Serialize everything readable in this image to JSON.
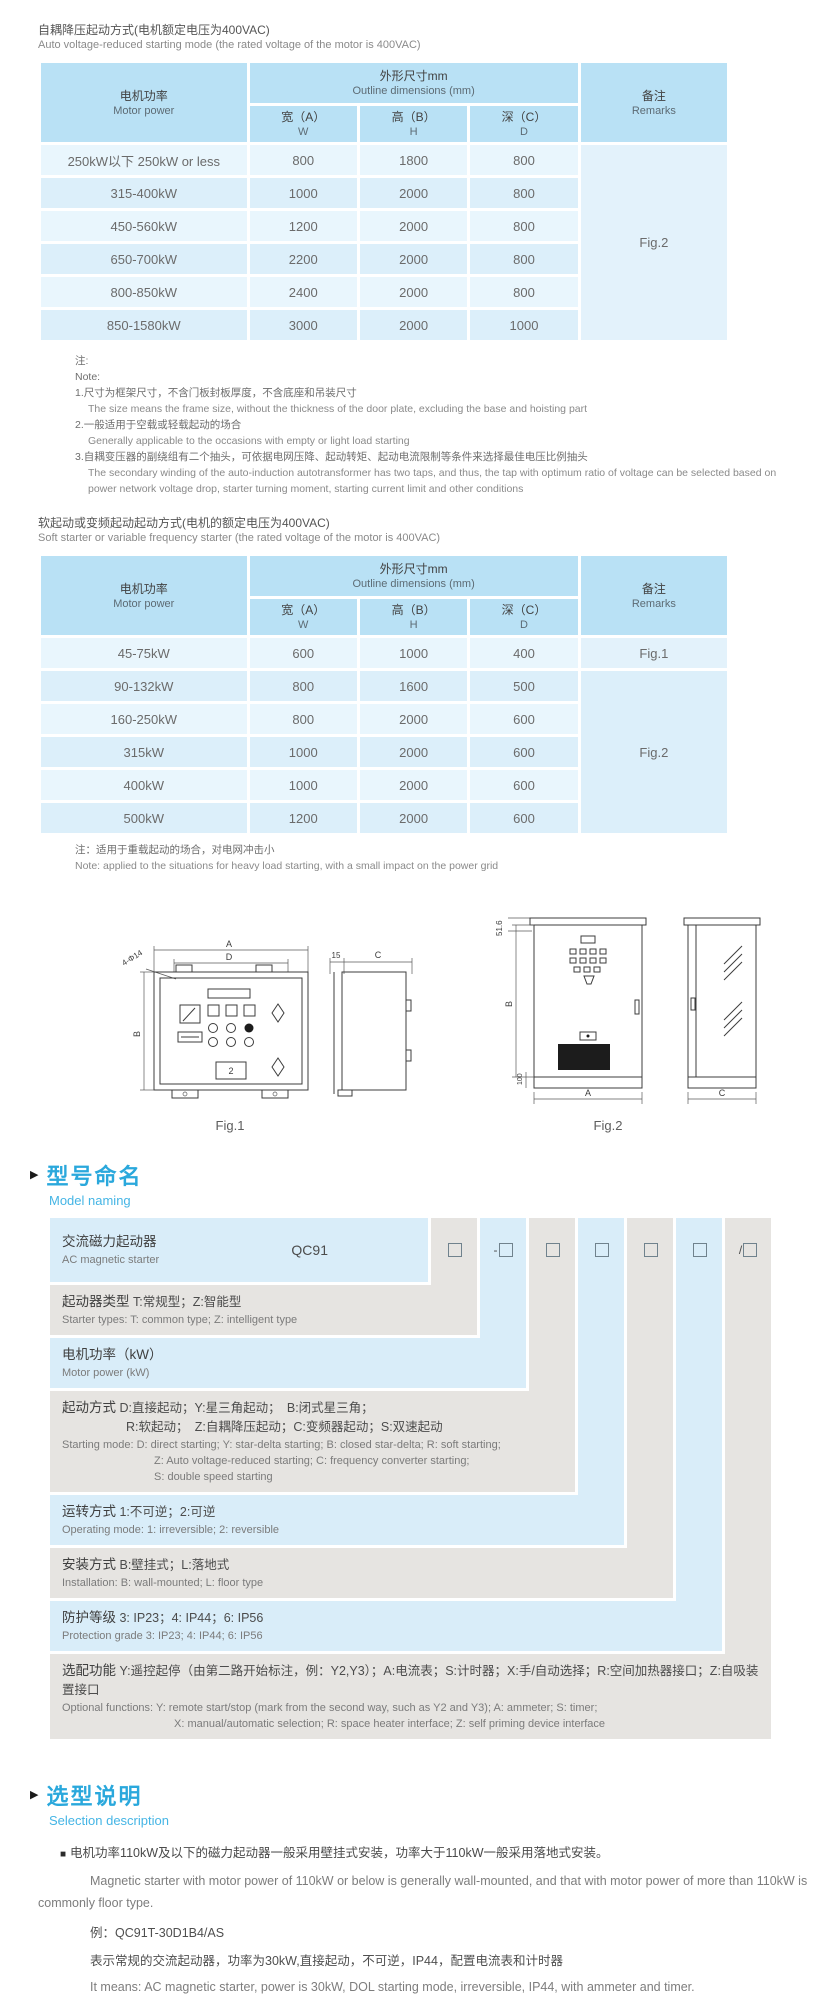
{
  "colors": {
    "heading_blue": "#2aa8dc",
    "heading_blue_light": "#45b5e5",
    "table_header_bg": "#b9e1f5",
    "row_blue_light": "#e9f6fd",
    "row_blue": "#dceffa",
    "model_gray": "#e6e4e1",
    "model_blue": "#d9edf9"
  },
  "ui": {
    "section_marker": "▶",
    "bullet": "■"
  },
  "table_header": {
    "motor_cn": "电机功率",
    "motor_en": "Motor power",
    "dims_cn": "外形尺寸mm",
    "dims_en": "Outline dimensions (mm)",
    "w_cn": "宽（A）",
    "w_en": "W",
    "h_cn": "高（B）",
    "h_en": "H",
    "d_cn": "深（C）",
    "d_en": "D",
    "remarks_cn": "备注",
    "remarks_en": "Remarks"
  },
  "table1": {
    "title_cn": "自耦降压起动方式(电机额定电压为400VAC)",
    "title_en": "Auto voltage-reduced starting mode (the rated voltage of the motor is 400VAC)",
    "rows": [
      {
        "power": "250kW以下 250kW or less",
        "w": "800",
        "h": "1800",
        "d": "800"
      },
      {
        "power": "315-400kW",
        "w": "1000",
        "h": "2000",
        "d": "800"
      },
      {
        "power": "450-560kW",
        "w": "1200",
        "h": "2000",
        "d": "800"
      },
      {
        "power": "650-700kW",
        "w": "2200",
        "h": "2000",
        "d": "800"
      },
      {
        "power": "800-850kW",
        "w": "2400",
        "h": "2000",
        "d": "800"
      },
      {
        "power": "850-1580kW",
        "w": "3000",
        "h": "2000",
        "d": "1000"
      }
    ],
    "remark": "Fig.2"
  },
  "note1": {
    "mark_cn": "注:",
    "mark_en": "Note:",
    "items": [
      {
        "cn": "1.尺寸为框架尺寸，不含门板封板厚度，不含底座和吊装尺寸",
        "en": "The size means the frame size, without the thickness of the door plate, excluding the base and hoisting part"
      },
      {
        "cn": "2.一般适用于空载或轻载起动的场合",
        "en": "Generally applicable to the occasions with empty or light load starting"
      },
      {
        "cn": "3.自耦变压器的副绕组有二个抽头，可依据电网压降、起动转矩、起动电流限制等条件来选择最佳电压比例抽头",
        "en": "The secondary winding of the auto-induction autotransformer has two taps, and thus, the tap with optimum ratio of voltage can be selected based on power network voltage drop, starter turning moment, starting current limit and other conditions"
      }
    ]
  },
  "table2": {
    "title_cn": "软起动或变频起动起动方式(电机的额定电压为400VAC)",
    "title_en": "Soft starter or variable frequency starter (the rated voltage of the motor is 400VAC)",
    "rows": [
      {
        "power": "45-75kW",
        "w": "600",
        "h": "1000",
        "d": "400",
        "remark": "Fig.1"
      },
      {
        "power": "90-132kW",
        "w": "800",
        "h": "1600",
        "d": "500"
      },
      {
        "power": "160-250kW",
        "w": "800",
        "h": "2000",
        "d": "600"
      },
      {
        "power": "315kW",
        "w": "1000",
        "h": "2000",
        "d": "600"
      },
      {
        "power": "400kW",
        "w": "1000",
        "h": "2000",
        "d": "600"
      },
      {
        "power": "500kW",
        "w": "1200",
        "h": "2000",
        "d": "600"
      }
    ],
    "remark_merged": "Fig.2"
  },
  "note2": {
    "cn": "注：适用于重载起动的场合，对电网冲击小",
    "en": "Note: applied to the situations for heavy load starting, with a small impact on the power grid"
  },
  "figures": {
    "fig1": {
      "caption": "Fig.1",
      "dim_a": "A",
      "dim_d": "D",
      "dim_holes": "4-Φ14",
      "dim_b": "B",
      "dim_15": "15",
      "dim_c": "C",
      "panel_label": "2"
    },
    "fig2": {
      "caption": "Fig.2",
      "dim_top": "51.6",
      "dim_b": "B",
      "dim_100": "100",
      "dim_a": "A",
      "dim_c": "C"
    }
  },
  "model": {
    "heading_cn": "型号命名",
    "heading_en": "Model naming",
    "code": "QC91",
    "boxes": [
      "",
      "-",
      "",
      "",
      "",
      "",
      "/"
    ],
    "rows": [
      {
        "label_cn": "交流磁力起动器",
        "en": "AC magnetic starter"
      },
      {
        "label_cn": "起动器类型",
        "detail_cn": "T:常规型；Z:智能型",
        "en": "Starter types: T: common type; Z: intelligent type"
      },
      {
        "label_cn": "电机功率（kW）",
        "detail_cn": "",
        "en": "Motor power (kW)"
      },
      {
        "label_cn": "起动方式",
        "detail_cn": "D:直接起动；Y:星三角起动；　B:闭式星三角；",
        "detail_cn2": "R:软起动；　Z:自耦降压起动；C:变频器起动；S:双速起动",
        "en": "Starting mode: D: direct starting; Y: star-delta starting; B: closed star-delta; R: soft starting;",
        "en2": "Z: Auto voltage-reduced starting; C: frequency converter starting;",
        "en3": "S: double speed starting"
      },
      {
        "label_cn": "运转方式",
        "detail_cn": "1:不可逆；2:可逆",
        "en": "Operating mode: 1: irreversible; 2: reversible"
      },
      {
        "label_cn": "安装方式",
        "detail_cn": "B:壁挂式；L:落地式",
        "en": "Installation: B: wall-mounted;  L: floor type"
      },
      {
        "label_cn": "防护等级",
        "detail_cn": "3: IP23；4: IP44；6: IP56",
        "en": "Protection grade  3: IP23;  4: IP44;  6: IP56"
      },
      {
        "label_cn": "选配功能",
        "detail_cn": "Y:遥控起停（由第二路开始标注，例：Y2,Y3）；A:电流表；S:计时器；X:手/自动选择；R:空间加热器接口；Z:自吸装置接口",
        "en": "Optional functions: Y: remote start/stop (mark from the second way, such as Y2 and Y3); A: ammeter; S: timer;",
        "en2": "X: manual/automatic selection; R: space heater interface; Z: self priming device interface"
      }
    ]
  },
  "selection": {
    "heading_cn": "选型说明",
    "heading_en": "Selection description",
    "p1_cn": "电机功率110kW及以下的磁力起动器一般采用壁挂式安装，功率大于110kW一般采用落地式安装。",
    "p1_en": "Magnetic starter with motor power of 110kW or below is generally wall-mounted, and that with motor power of more than 110kW is commonly floor type.",
    "example_label": "例：QC91T-30D1B4/AS",
    "example_cn": "表示常规的交流起动器，功率为30kW,直接起动，不可逆，IP44，配置电流表和计时器",
    "example_en": "It means: AC magnetic starter, power is 30kW, DOL starting mode, irreversible, IP44, with ammeter and timer."
  }
}
